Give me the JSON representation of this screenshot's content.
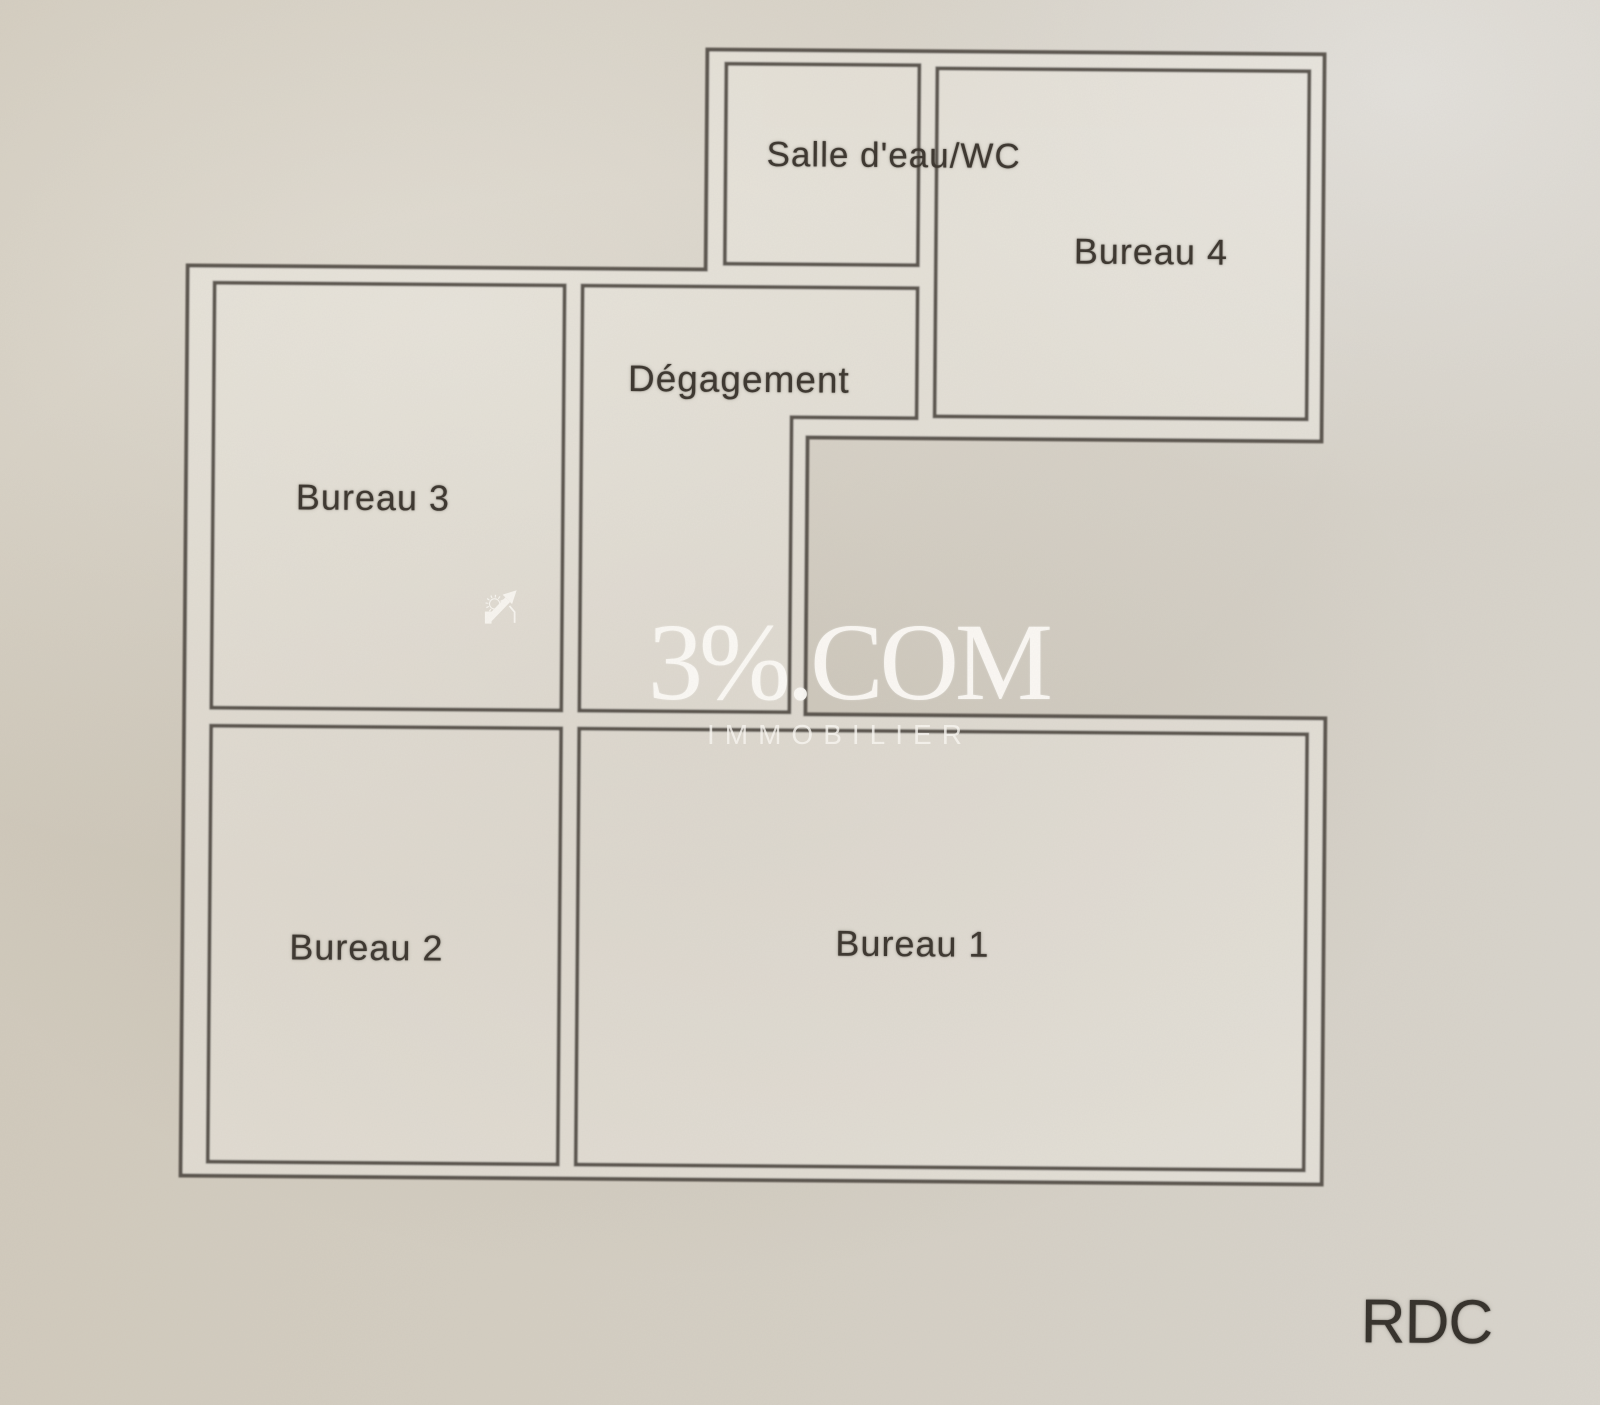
{
  "plan": {
    "rooms": [
      {
        "id": "salle_eau_wc",
        "label": "Salle d'eau/WC"
      },
      {
        "id": "bureau_4",
        "label": "Bureau 4"
      },
      {
        "id": "degagement",
        "label": "Dégagement"
      },
      {
        "id": "bureau_3",
        "label": "Bureau 3"
      },
      {
        "id": "bureau_2",
        "label": "Bureau 2"
      },
      {
        "id": "bureau_1",
        "label": "Bureau 1"
      }
    ],
    "floor_label": "RDC"
  },
  "watermark": {
    "brand": "3%.COM",
    "subtitle": "IMMOBILIER",
    "logo": "sun-arrow-icon",
    "color": "#faf8f3"
  },
  "colors": {
    "paper": "#d2cbbd",
    "paper_light": "#ddd9d2",
    "wall_line": "#4d4740",
    "label_text": "#3c362f"
  }
}
